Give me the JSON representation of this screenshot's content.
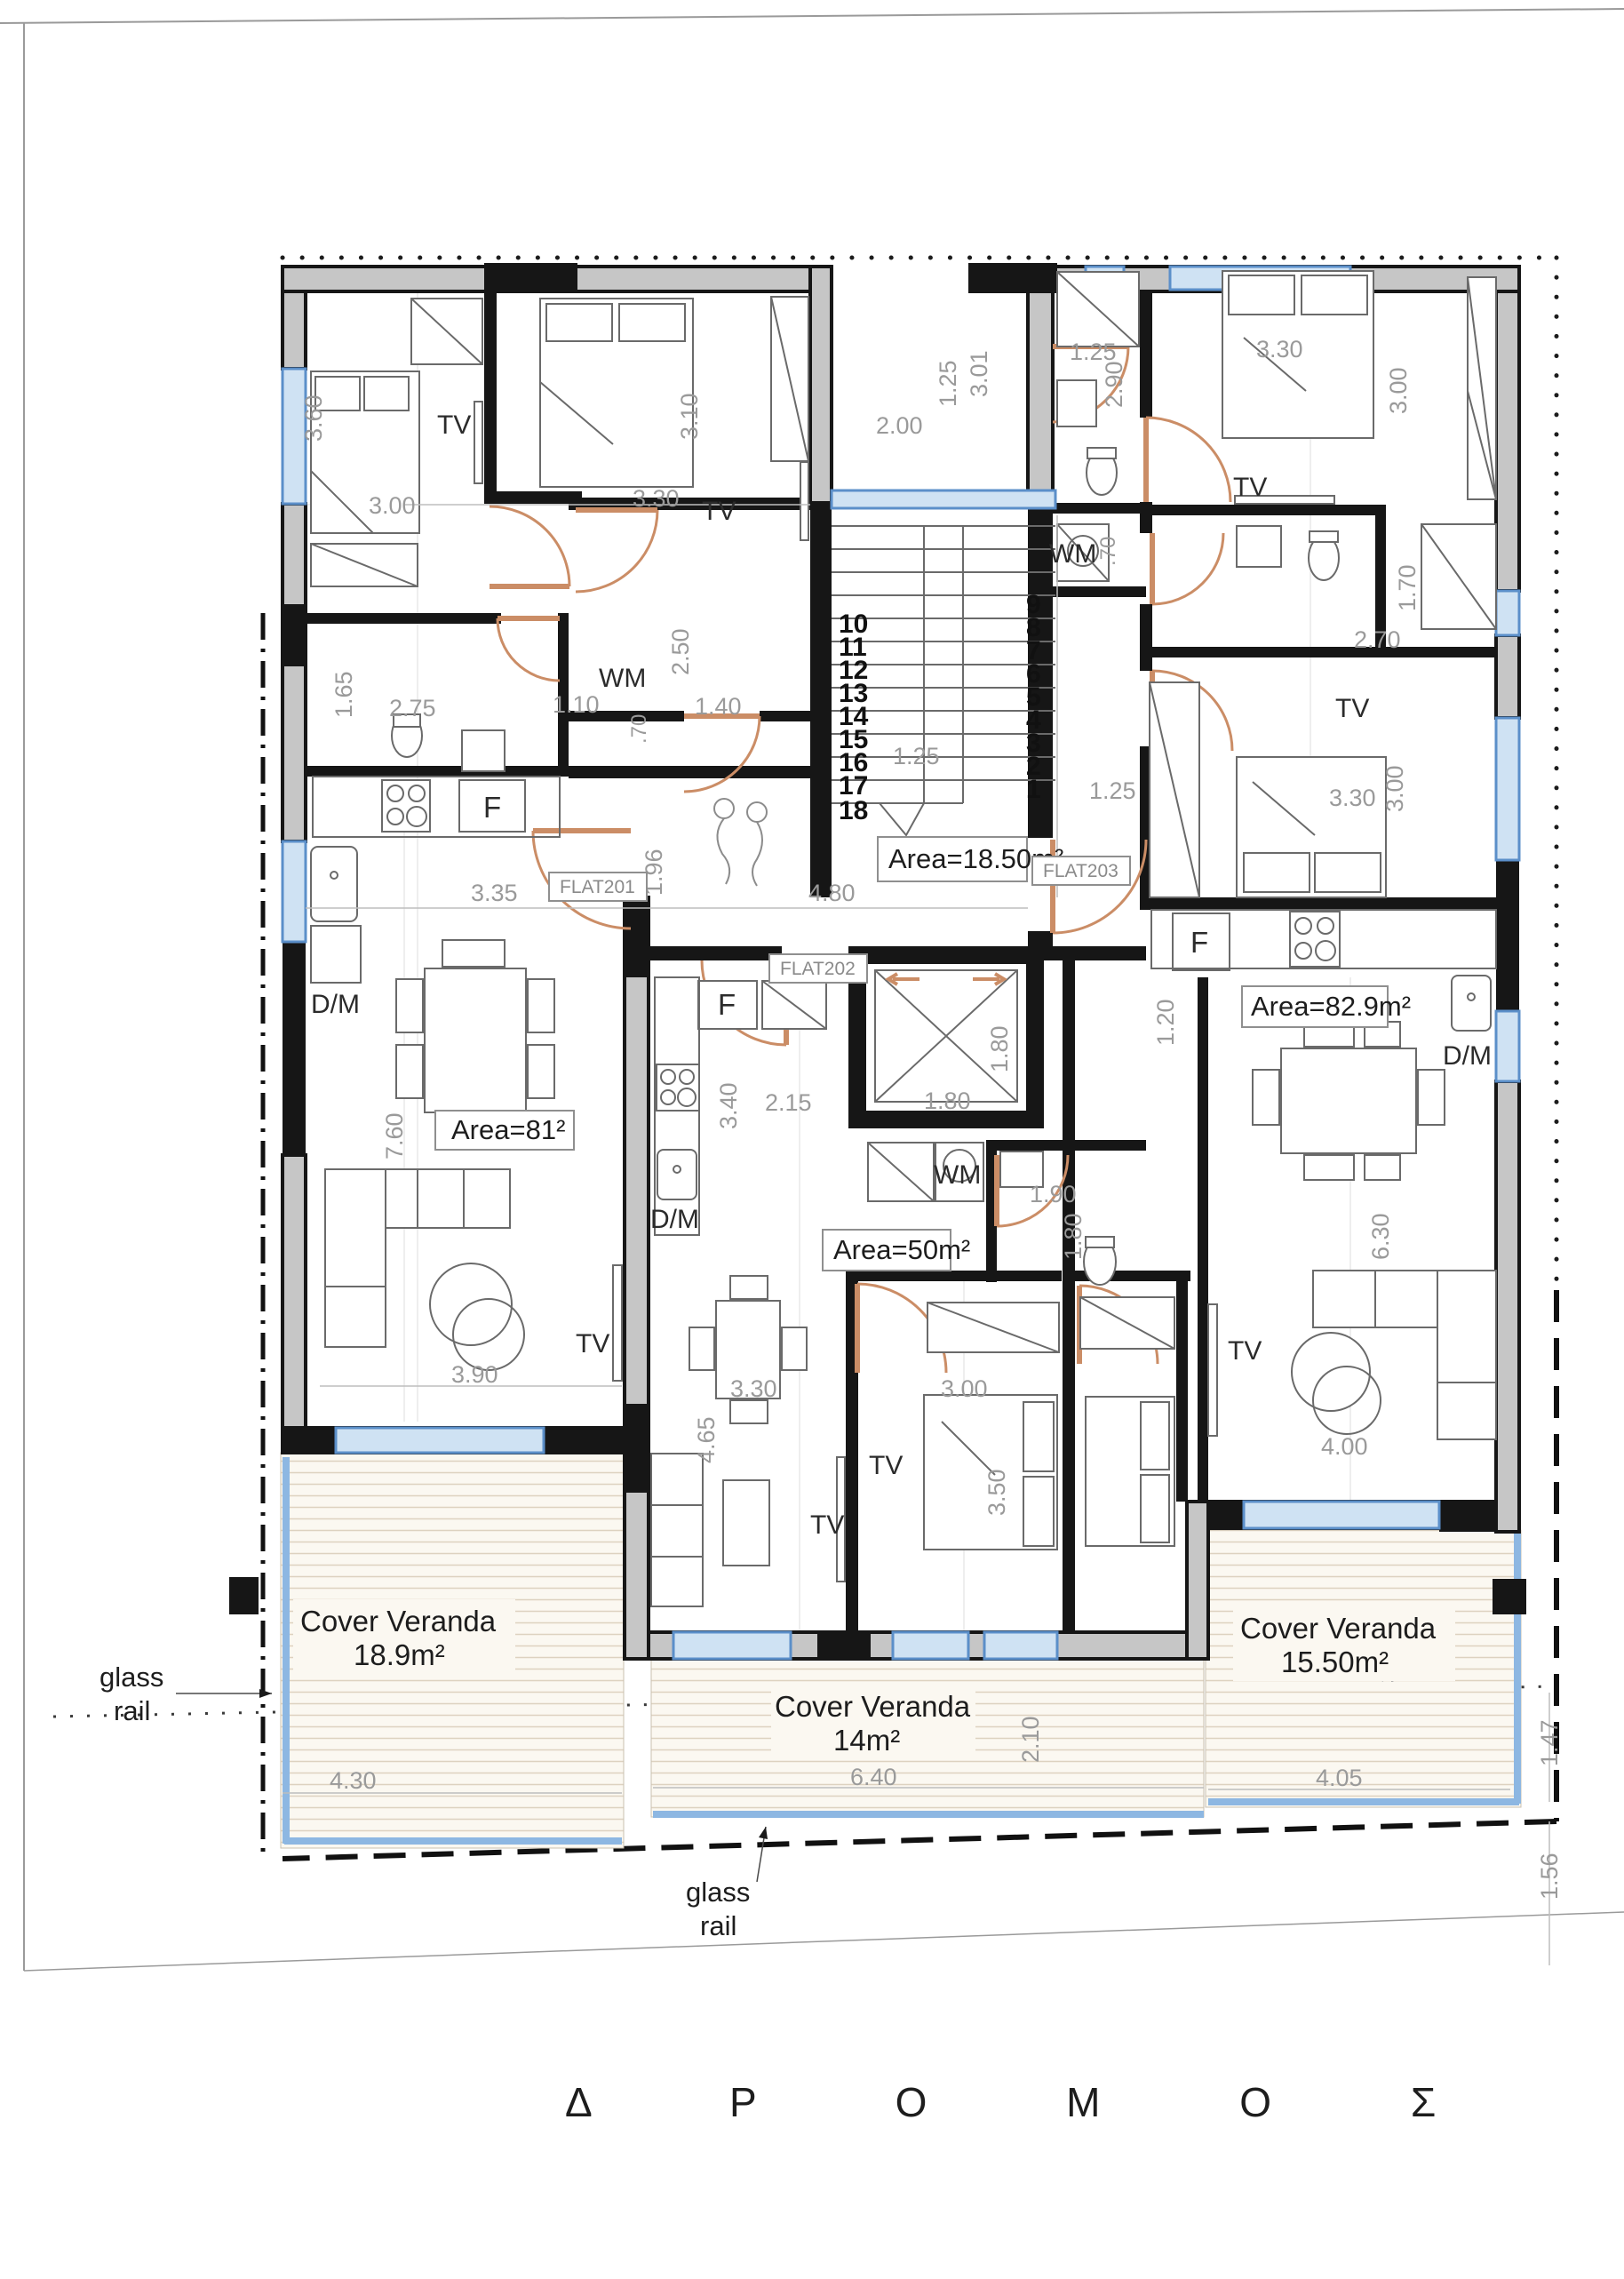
{
  "road_label": "Δ Ρ Ο Μ Ο Σ",
  "glass_rail": {
    "line1": "glass",
    "line2": "rail"
  },
  "flat_tags": {
    "f201": "FLAT201",
    "f202": "FLAT202",
    "f203": "FLAT203"
  },
  "area_boxes": {
    "stair": "Area=18.50m²",
    "f201": "Area=81²",
    "f202": "Area=50m²",
    "f203": "Area=82.9m²"
  },
  "verandas": {
    "title": "Cover Veranda",
    "left_area": "18.9m²",
    "mid_area": "14m²",
    "right_area": "15.50m²"
  },
  "appliances": {
    "tv": "TV",
    "wm": "WM",
    "fridge": "F",
    "dish": "D/M"
  },
  "stairs": {
    "left": [
      "10",
      "11",
      "12",
      "13",
      "14",
      "15",
      "16",
      "17",
      "18"
    ],
    "right": [
      "9",
      "8",
      "7",
      "6",
      "5",
      "4",
      "3",
      "2",
      "1"
    ]
  },
  "dims": {
    "d1": "3.00",
    "d2": "3.60",
    "d3": "3.30",
    "d4": "3.10",
    "d5": "2.50",
    "d6": "1.10",
    "d7": "1.65",
    "d8": "2.75",
    "d9": "1.40",
    "d10": ".70",
    "d11": "3.35",
    "d12": "7.60",
    "d13": "3.90",
    "d14": "1.96",
    "d15": "4.80",
    "d16": "1.25",
    "d17": "2.00",
    "d18": "3.01",
    "d19": "1.25",
    "d20": "1.25",
    "d21": "1.80",
    "d22": "1.80",
    "d23": "3.40",
    "d24": "2.15",
    "d25": "1.90",
    "d26": "1.80",
    "d27": "3.30",
    "d28": "4.65",
    "d29": "3.00",
    "d30": "3.50",
    "d31": "2.10",
    "d32": "6.40",
    "d33": "1.25",
    "d34": "2.90",
    "d35": "3.30",
    "d36": "3.00",
    "d37": ".70",
    "d38": "1.70",
    "d39": "2.70",
    "d40": "3.30",
    "d41": "3.00",
    "d42": "1.20",
    "d43": "6.30",
    "d44": "4.00",
    "d45": "3.55",
    "d46": "4.05",
    "d47": "1.47",
    "d48": "1.56",
    "d49": "4.10",
    "d50": "4.30"
  }
}
